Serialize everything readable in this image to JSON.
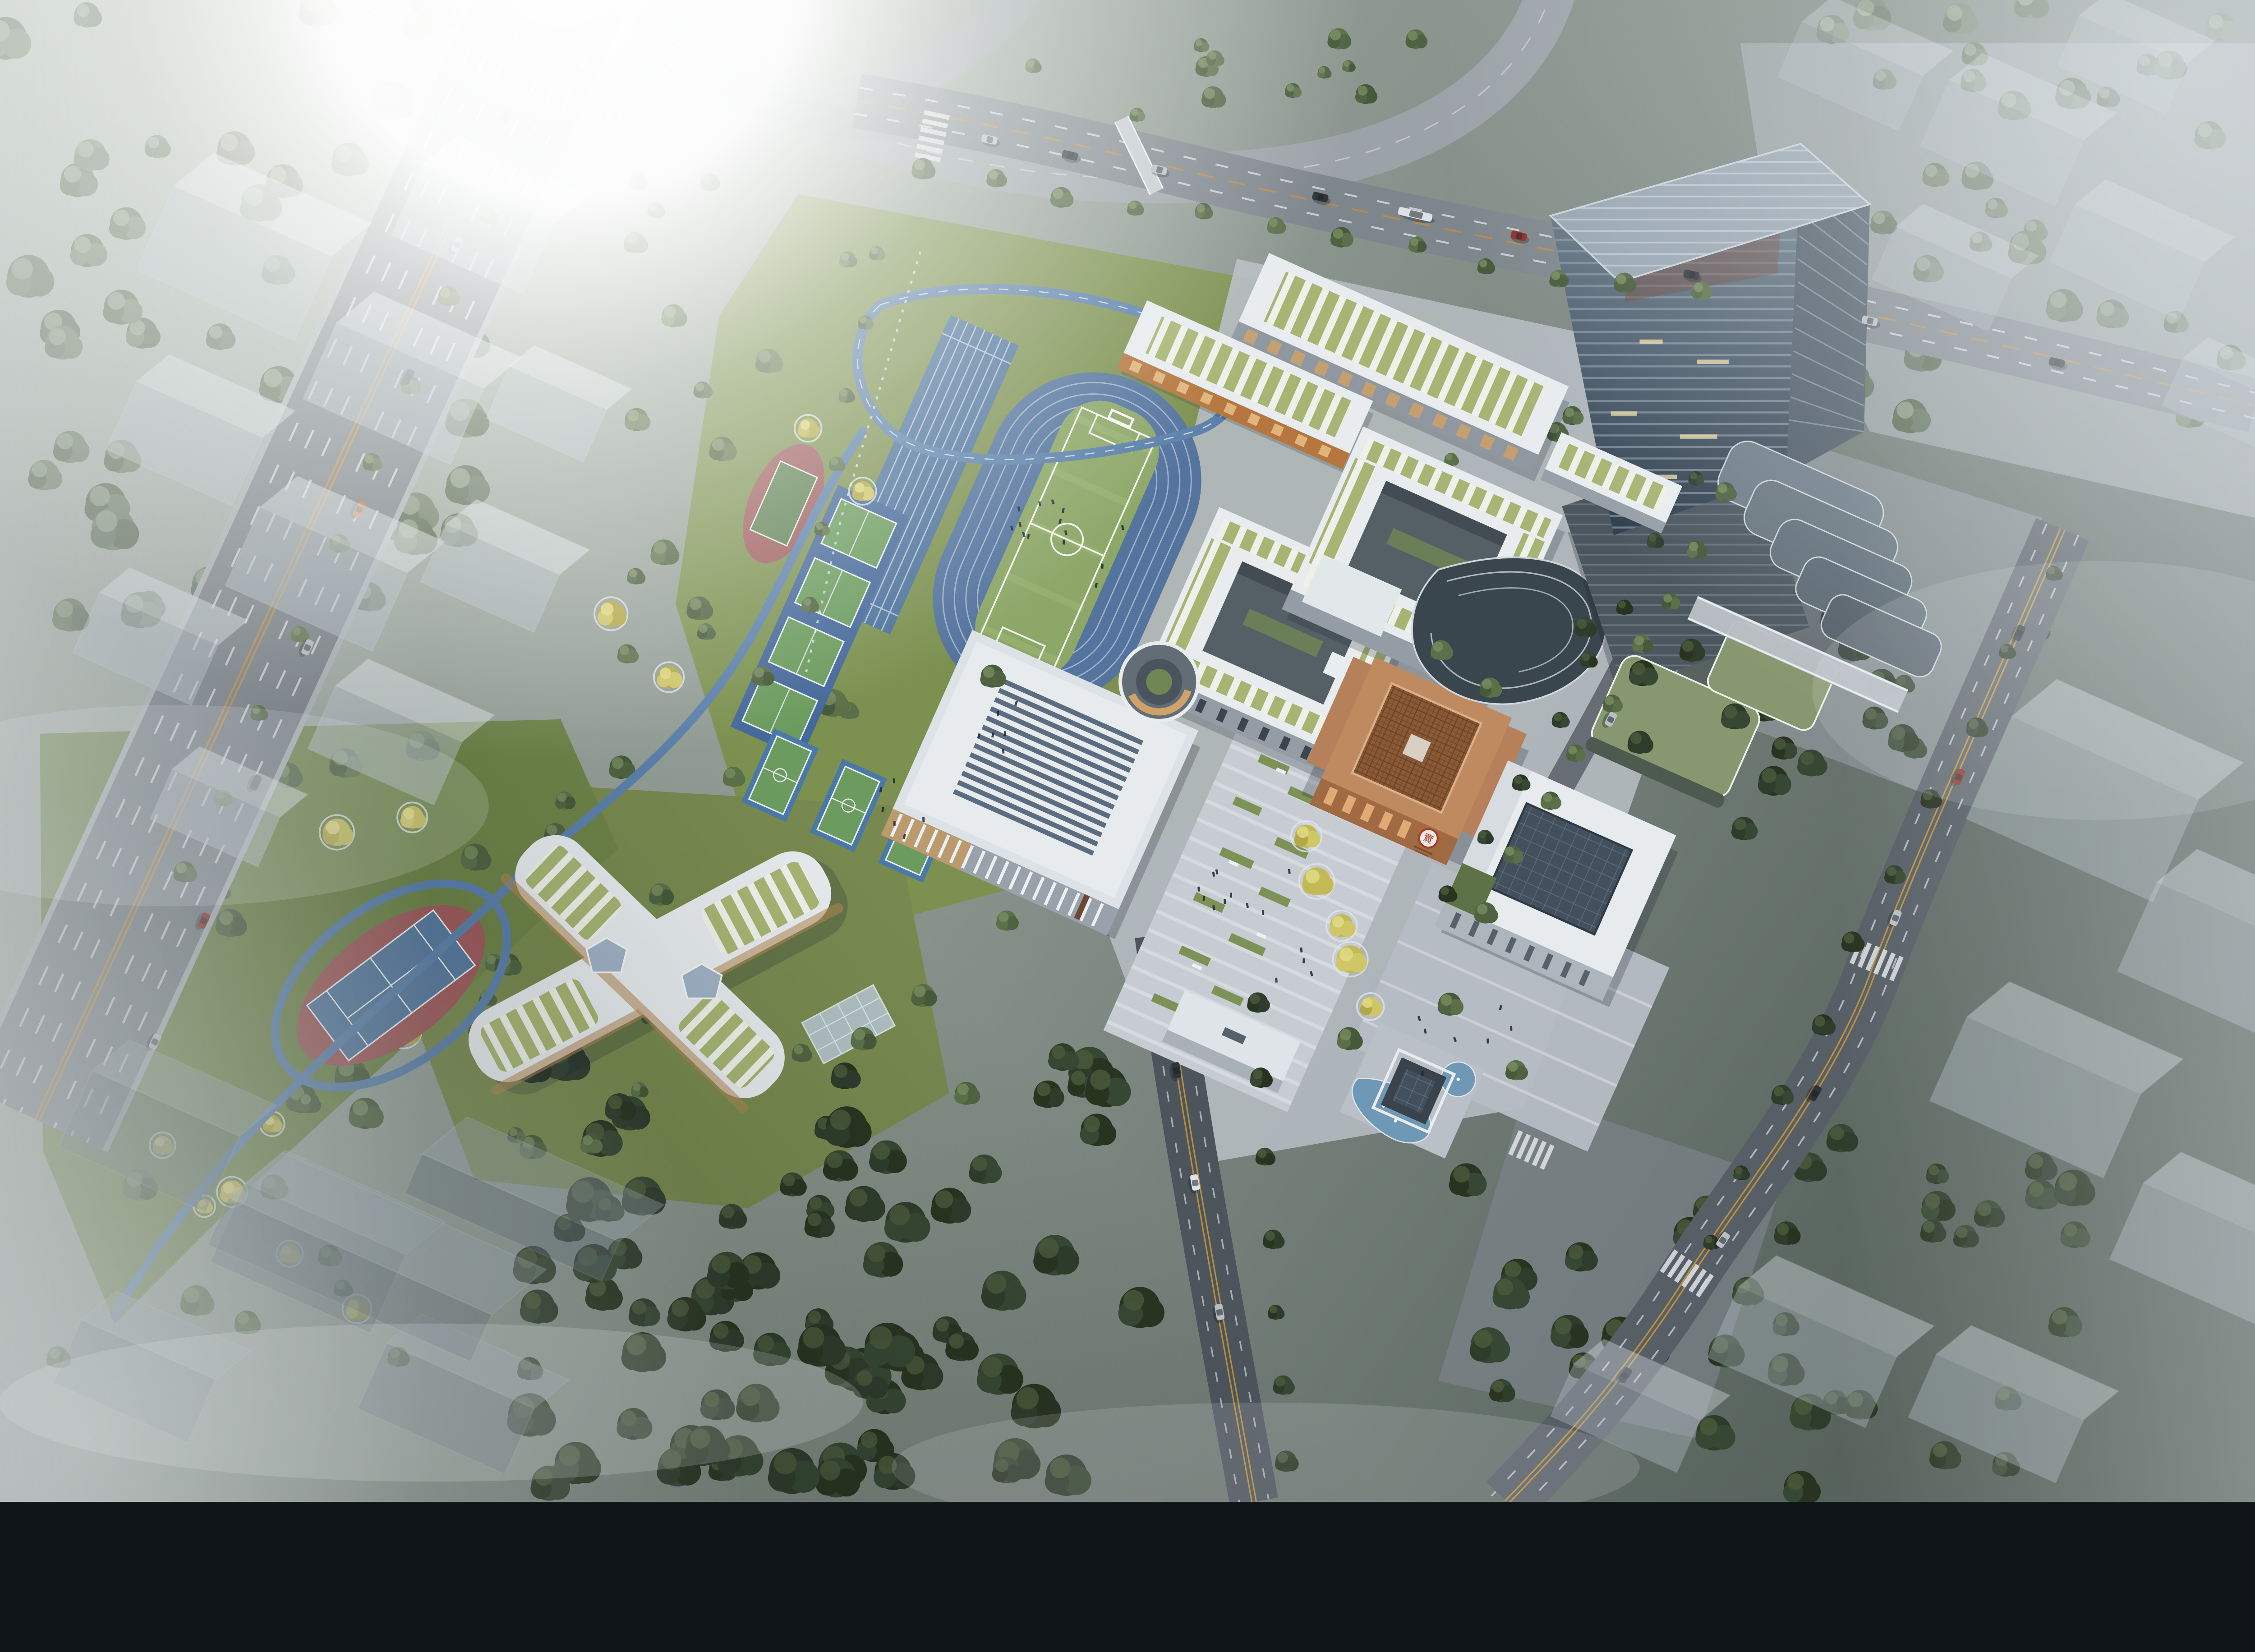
{
  "scene": {
    "title": "Aerial rendering of a school campus beside a foggy highway interchange and glass office tower",
    "type": "architectural-visualization",
    "atmosphere": "hazy daylight with sun flare top-left and drifting fog at edges"
  },
  "palette": {
    "track_blue": "#54749e",
    "lane_line": "#cfdbe8",
    "field_green": "#8da768",
    "lawn": "#7c9150",
    "forest_dark": "#2f3d2c",
    "plaza": "#c6ccd2",
    "roof_white": "#e8ecef",
    "roof_green_stripe": "#a6b573",
    "copper_building": "#c18a5f",
    "copper_lattice": "#7d4f2c",
    "seal_red": "#a93b2d",
    "tower_glass_dark": "#2f3d4a",
    "tower_glass_light": "#6b7d8d",
    "road_grey": "#7e868d",
    "road_dark": "#565e66",
    "double_yellow": "#b98f3e",
    "pond_blue": "#6f98b6",
    "ginkgo_yellow": "#c3ba55",
    "ghost_block_top": "#e3eaf0"
  },
  "campus": {
    "buildings": [
      {
        "id": "teaching-slab-north",
        "label": "north teaching slab with green pergola roof"
      },
      {
        "id": "teaching-slab-second",
        "label": "second teaching slab with orange facade"
      },
      {
        "id": "teaching-courtyard-east",
        "label": "east courtyard teaching block"
      },
      {
        "id": "teaching-courtyard-west",
        "label": "west courtyard teaching block"
      },
      {
        "id": "gymnasium",
        "label": "gymnasium / auditorium with folded skylight roof"
      },
      {
        "id": "library-copper",
        "label": "copper lattice library cube"
      },
      {
        "id": "science-block",
        "label": "white block with dark glass skylight"
      },
      {
        "id": "kindergarten-x",
        "label": "X-shaped kindergarten with green roof strips"
      },
      {
        "id": "office-tower",
        "label": "tapered glass office tower with cascading terraces"
      },
      {
        "id": "sunken-courtyard",
        "label": "circular sunken courtyard"
      },
      {
        "id": "entrance-gate",
        "label": "campus entrance gate"
      },
      {
        "id": "pavilion-pond",
        "label": "dark pavilion with fountain ponds"
      }
    ],
    "library_seal": {
      "glyph": "實",
      "ring_color": "#a93b2d"
    },
    "sports": {
      "running_track_lanes": 6,
      "soccer_fields": 1,
      "sprint_straight": 1,
      "net_courts": 4,
      "basketball_courts": 3,
      "park_tennis_courts": 1,
      "park_mini_court": 1,
      "jogging_loops": 2
    }
  },
  "context": {
    "ghost_massing_blocks": true,
    "highway_lanes": 8,
    "interchange_ramps": 3,
    "pedestrian_bridges": 2,
    "crosswalks": 5
  },
  "generator": {
    "tree_palettes": {
      "green": [
        "#4f6342",
        "#5b7049",
        "#46593a"
      ],
      "dark": [
        "#2e3c2c",
        "#364733",
        "#283420"
      ],
      "foggy": [
        "#5f705c",
        "#6b7b61",
        "#55654b"
      ],
      "ginkgo": [
        "#c3ba55",
        "#cfc668",
        "#b2a845"
      ]
    },
    "tree_highlights": {
      "green": "#76895e",
      "dark": "#49593b",
      "foggy": "#8b9b82",
      "ginkgo": "#e2da85"
    },
    "tree_regions": [
      [
        "forest-top-left",
        0,
        0,
        350,
        430,
        62,
        "foggy",
        8,
        15
      ],
      [
        "forest-bottom",
        368,
        730,
        430,
        310,
        80,
        "dark",
        8,
        16
      ],
      [
        "forest-bottom-right",
        1010,
        790,
        440,
        250,
        38,
        "dark",
        7,
        13
      ],
      [
        "park-west",
        398,
        120,
        210,
        420,
        20,
        "mixed",
        5,
        10
      ],
      [
        "linear-park",
        28,
        516,
        350,
        430,
        28,
        "mixed",
        5,
        11
      ],
      [
        "east-slope",
        1196,
        408,
        226,
        168,
        18,
        "dark",
        6,
        11
      ],
      [
        "north-verge",
        560,
        24,
        430,
        64,
        14,
        "green",
        4,
        8
      ],
      [
        "top-right-forest",
        1230,
        0,
        338,
        290,
        34,
        "foggy",
        7,
        12
      ],
      [
        "kinder-lawn",
        318,
        556,
        330,
        270,
        13,
        "mixed",
        5,
        9
      ],
      [
        "campus-green",
        952,
        276,
        210,
        110,
        8,
        "green",
        4,
        7
      ]
    ],
    "tree_rows": [
      [
        640,
        118,
        1180,
        206,
        12,
        "green",
        6
      ],
      [
        1202,
        342,
        1034,
        632,
        9,
        "green",
        6
      ],
      [
        1176,
        336,
        1010,
        624,
        8,
        "dark",
        5
      ],
      [
        1424,
        398,
        1186,
        866,
        10,
        "dark",
        6
      ],
      [
        874,
        700,
        896,
        1016,
        7,
        "dark",
        6
      ],
      [
        368,
        94,
        130,
        610,
        10,
        "green",
        6
      ],
      [
        606,
        176,
        566,
        420,
        6,
        "green",
        5
      ],
      [
        908,
        582,
        952,
        700,
        5,
        "ginkgo",
        8
      ],
      [
        114,
        794,
        246,
        908,
        4,
        "ginkgo",
        7
      ],
      [
        560,
        300,
        600,
        344,
        2,
        "ginkgo",
        8
      ]
    ],
    "extra_trees": [
      [
        1142,
        468,
        9,
        "dark"
      ],
      [
        1176,
        452,
        8,
        "dark"
      ],
      [
        1206,
        498,
        9,
        "dark"
      ],
      [
        1140,
        516,
        8,
        "dark"
      ],
      [
        1240,
        520,
        8,
        "dark"
      ],
      [
        1102,
        436,
        7,
        "dark"
      ],
      [
        938,
        722,
        8,
        "green"
      ],
      [
        1008,
        698,
        8,
        "green"
      ],
      [
        1054,
        744,
        7,
        "green"
      ],
      [
        690,
        470,
        8,
        "green"
      ],
      [
        1002,
        452,
        7,
        "green"
      ],
      [
        1036,
        478,
        7,
        "green"
      ],
      [
        600,
        722,
        8,
        "green"
      ],
      [
        642,
        692,
        8,
        "green"
      ],
      [
        672,
        760,
        8,
        "green"
      ],
      [
        530,
        470,
        7,
        "green"
      ],
      [
        510,
        540,
        7,
        "green"
      ],
      [
        700,
        640,
        7,
        "green"
      ]
    ],
    "cars": [
      [
        352,
        80,
        115,
        "#2e3338",
        11
      ],
      [
        318,
        170,
        115,
        "#b8bec3",
        11
      ],
      [
        284,
        262,
        115,
        "#2e3338",
        11
      ],
      [
        250,
        354,
        115,
        "#c96f35",
        11
      ],
      [
        214,
        450,
        115,
        "#b8bec3",
        11
      ],
      [
        178,
        544,
        115,
        "#2e3338",
        11
      ],
      [
        142,
        640,
        115,
        "#8d2f26",
        11
      ],
      [
        108,
        724,
        115,
        "#b8bec3",
        11
      ],
      [
        688,
        97,
        12,
        "#b8bec3",
        11
      ],
      [
        744,
        108,
        13,
        "#2e3338",
        11
      ],
      [
        806,
        118,
        13,
        "#b8bec3",
        11
      ],
      [
        918,
        137,
        14,
        "#2e3338",
        11
      ],
      [
        1056,
        164,
        14,
        "#8d2f26",
        11
      ],
      [
        1176,
        191,
        12,
        "#2e3338",
        11
      ],
      [
        1300,
        223,
        13,
        "#b8bec3",
        11
      ],
      [
        1430,
        252,
        13,
        "#2e3338",
        11
      ],
      [
        984,
        149,
        13,
        "#dde2e6",
        24
      ],
      [
        1404,
        440,
        113,
        "#2e3338",
        11
      ],
      [
        1362,
        540,
        113,
        "#8d2f26",
        11
      ],
      [
        1318,
        638,
        112,
        "#b8bec3",
        11
      ],
      [
        1262,
        760,
        120,
        "#2e3338",
        11
      ],
      [
        1198,
        862,
        124,
        "#b8bec3",
        11
      ],
      [
        1130,
        956,
        126,
        "#2e3338",
        11
      ],
      [
        818,
        744,
        81,
        "#2e3338",
        11
      ],
      [
        831,
        822,
        80,
        "#dde2e6",
        11
      ],
      [
        848,
        912,
        80,
        "#b8bec3",
        11
      ],
      [
        1120,
        500,
        118,
        "#b8bec3",
        10
      ]
    ],
    "ghost_clusters": [
      {
        "tone": "light",
        "op": 0.5,
        "blocks": [
          [
            150,
            212,
            120,
            32,
            64
          ],
          [
            262,
            300,
            112,
            30,
            58
          ],
          [
            118,
            332,
            96,
            26,
            52
          ],
          [
            318,
            184,
            100,
            28,
            54
          ],
          [
            208,
            430,
            112,
            30,
            60
          ],
          [
            92,
            472,
            90,
            24,
            46
          ],
          [
            332,
            422,
            86,
            24,
            44
          ],
          [
            258,
            540,
            96,
            26,
            48
          ],
          [
            142,
            586,
            82,
            22,
            38
          ],
          [
            372,
            306,
            74,
            20,
            40
          ]
        ]
      },
      {
        "tone": "light",
        "op": 0.3,
        "blocks": [
          [
            1278,
            72,
            92,
            24,
            42
          ],
          [
            1382,
            122,
            102,
            26,
            50
          ],
          [
            1468,
            62,
            82,
            22,
            38
          ],
          [
            1342,
            212,
            88,
            22,
            40
          ],
          [
            1470,
            202,
            98,
            24,
            44
          ],
          [
            1540,
            298,
            80,
            20,
            36
          ]
        ]
      },
      {
        "tone": "light",
        "op": 0.38,
        "blocks": [
          [
            1432,
            598,
            142,
            36,
            78
          ],
          [
            1528,
            700,
            122,
            32,
            68
          ],
          [
            1402,
            792,
            132,
            34,
            64
          ],
          [
            1518,
            898,
            112,
            30,
            58
          ]
        ]
      },
      {
        "tone": "light",
        "op": 0.36,
        "blocks": [
          [
            1242,
            968,
            120,
            30,
            54
          ],
          [
            1378,
            1008,
            112,
            28,
            48
          ],
          [
            1122,
            1004,
            96,
            24,
            40
          ]
        ]
      },
      {
        "tone": "dark",
        "op": 0.4,
        "blocks": [
          [
            92,
            820,
            112,
            30,
            58
          ],
          [
            202,
            902,
            122,
            32,
            60
          ],
          [
            84,
            982,
            102,
            28,
            48
          ],
          [
            300,
            1002,
            112,
            28,
            50
          ],
          [
            236,
            906,
            200,
            44,
            36
          ],
          [
            350,
            860,
            150,
            36,
            30
          ]
        ]
      }
    ],
    "ghost_tones": {
      "light": {
        "top": "#e3eaf0",
        "front": "#b7c2cc"
      },
      "dark": {
        "top": "#9aa8b4",
        "front": "#5f6d7a"
      }
    },
    "people_regions": [
      [
        746,
        374,
        52,
        14
      ],
      [
        880,
        640,
        60,
        16
      ],
      [
        1010,
        718,
        44,
        8
      ],
      [
        702,
        506,
        26,
        6
      ],
      [
        618,
        560,
        30,
        6
      ]
    ],
    "crosswalks": [
      [
        648,
        96,
        102,
        6
      ],
      [
        1306,
        668,
        23,
        6
      ],
      [
        1174,
        886,
        34,
        6
      ],
      [
        816,
        700,
        -10,
        5
      ],
      [
        1066,
        800,
        24,
        5
      ]
    ]
  }
}
